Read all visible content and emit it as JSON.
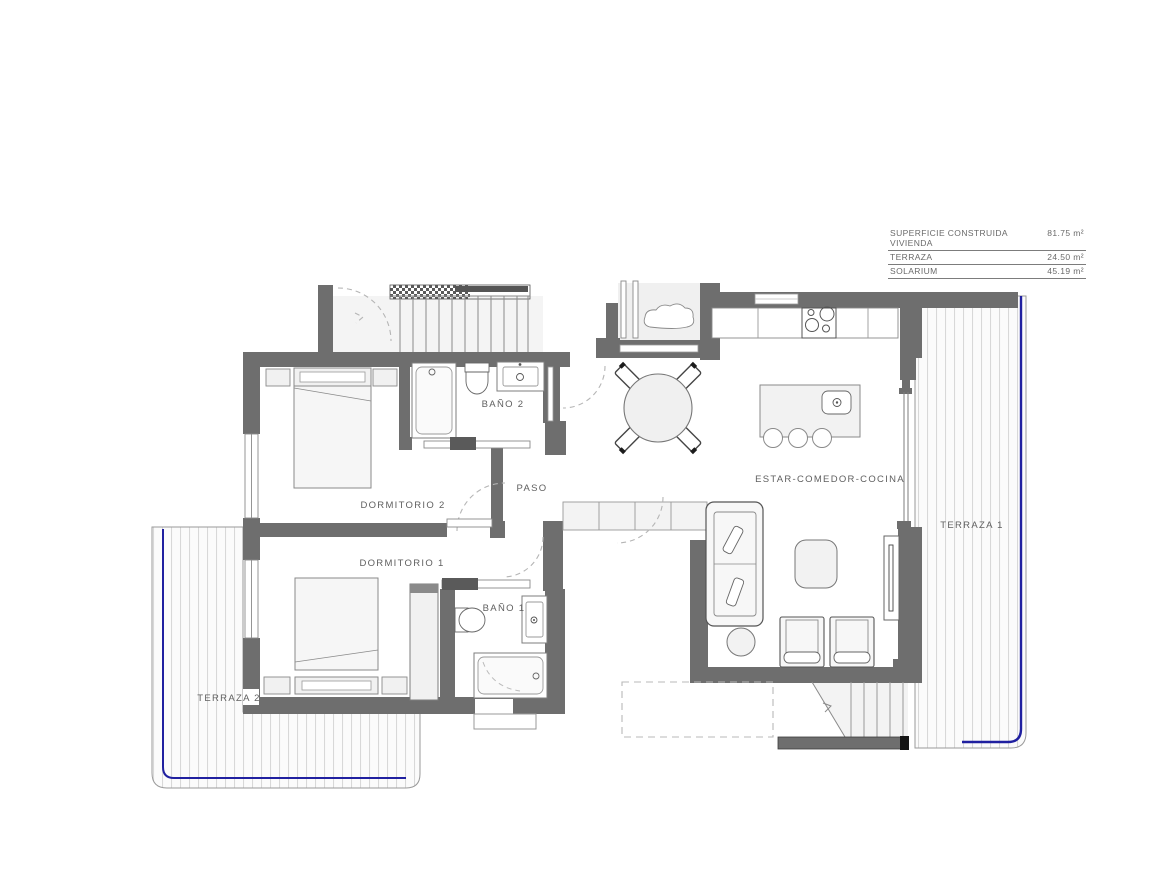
{
  "area_table": {
    "rows": [
      {
        "label": "SUPERFICIE CONSTRUIDA VIVIENDA",
        "value": "81.75 m²"
      },
      {
        "label": "TERRAZA",
        "value": "24.50 m²"
      },
      {
        "label": "SOLARIUM",
        "value": "45.19 m²"
      }
    ]
  },
  "rooms": {
    "bano2": "BAÑO 2",
    "dormitorio2": "DORMITORIO 2",
    "paso": "PASO",
    "dormitorio1": "DORMITORIO 1",
    "bano1": "BAÑO 1",
    "estar_comedor_cocina": "ESTAR-COMEDOR-COCINA",
    "terraza1": "TERRAZA 1",
    "terraza2": "TERRAZA 2"
  },
  "colors": {
    "wall": "#6e6e6e",
    "terrace_edge_blue": "#2020a0",
    "furniture_fill": "#f2f2f2",
    "deck_stripe": "#d8d8d8"
  }
}
